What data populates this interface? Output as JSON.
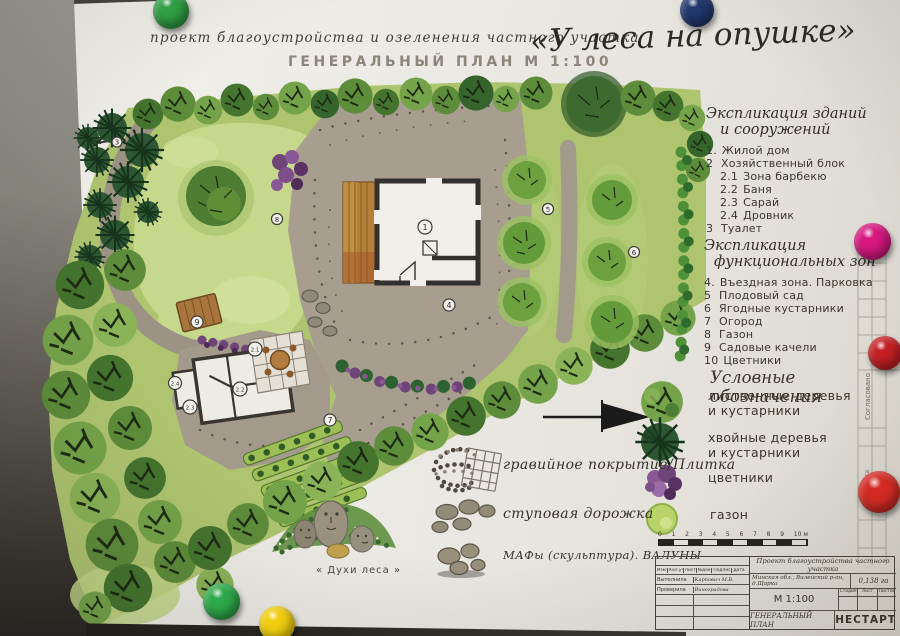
{
  "title": {
    "project_line": "проект  благоустройства  и  озеленения  частного  участка",
    "project_name": "«У леса на опушке»",
    "plan_line": "ГЕНЕРАЛЬНЫЙ  ПЛАН   М 1:100"
  },
  "plan": {
    "markers": [
      {
        "label": "1"
      },
      {
        "label": "2.1"
      },
      {
        "label": "2.2"
      },
      {
        "label": "2.3"
      },
      {
        "label": "2.4"
      },
      {
        "label": "3"
      },
      {
        "label": "4"
      },
      {
        "label": "5"
      },
      {
        "label": "6"
      },
      {
        "label": "7"
      },
      {
        "label": "8"
      },
      {
        "label": "9"
      }
    ],
    "sculpture_caption": "« Духи леса »"
  },
  "expl_buildings": {
    "title_line1": "Экспликация зданий",
    "title_line2": "и сооружений",
    "items": [
      {
        "num": "1.",
        "label": "Жилой дом"
      },
      {
        "num": "2",
        "label": "Хозяйственный блок"
      },
      {
        "num": "2.1",
        "label": "Зона барбекю"
      },
      {
        "num": "2.2",
        "label": "Баня"
      },
      {
        "num": "2.3",
        "label": "Сарай"
      },
      {
        "num": "2.4",
        "label": "Дровник"
      },
      {
        "num": "3",
        "label": "Туалет"
      }
    ]
  },
  "expl_zones": {
    "title_line1": "Экспликация",
    "title_line2": "функциональных зон",
    "items": [
      {
        "num": "4.",
        "label": "Въездная зона. Парковка"
      },
      {
        "num": "5",
        "label": "Плодовый сад"
      },
      {
        "num": "6",
        "label": "Ягодные кустарники"
      },
      {
        "num": "7",
        "label": "Огород"
      },
      {
        "num": "8",
        "label": "Газон"
      },
      {
        "num": "9",
        "label": "Садовые качели"
      },
      {
        "num": "10",
        "label": "Цветники"
      }
    ]
  },
  "legend": {
    "title": "Условные обозначения",
    "items": [
      {
        "icon": "deciduous-tree-icon",
        "line1": "лиственные деревья",
        "line2": "и кустарники"
      },
      {
        "icon": "conifer-tree-icon",
        "line1": "хвойные деревья",
        "line2": "и кустарники"
      },
      {
        "icon": "flowerbed-icon",
        "line1": "цветники",
        "line2": ""
      },
      {
        "icon": "lawn-icon",
        "line1": "газон",
        "line2": ""
      }
    ]
  },
  "surface_legend": {
    "items": [
      {
        "icon": "gravel-tile-icon",
        "label": "гравийное покрытие/Плитка"
      },
      {
        "icon": "stepping-stones-icon",
        "label": "ступовая дорожка"
      },
      {
        "icon": "boulders-icon",
        "label": "МАФы (скульптура). ВАЛУНЫ"
      }
    ]
  },
  "titleblock": {
    "scale_bar_numbers": [
      "0",
      "1",
      "2",
      "3",
      "4",
      "5",
      "6",
      "7",
      "8",
      "9",
      "10 м"
    ],
    "rev_cols": [
      "Изм",
      "Кол.уч",
      "Лист",
      "№док",
      "Подпись",
      "Дата"
    ],
    "made_by_label": "Выполнила",
    "made_by": "Карпович М.В.",
    "checked_label": "Проверила",
    "checked": "Виноградова",
    "project": "Проект благоустройства частного участка",
    "location": "Минская обл., Вилейский р-он, д.Щарка",
    "area": "0,138 га",
    "scale": "М 1:100",
    "stage": "Стадия",
    "sheet": "Лист",
    "sheets": "Листов",
    "doc_title": "ГЕНЕРАЛЬНЫЙ ПЛАН",
    "org": "НЕСТАРТ"
  },
  "side_strip": {
    "approved": "Согласовано",
    "date": "дата"
  }
}
